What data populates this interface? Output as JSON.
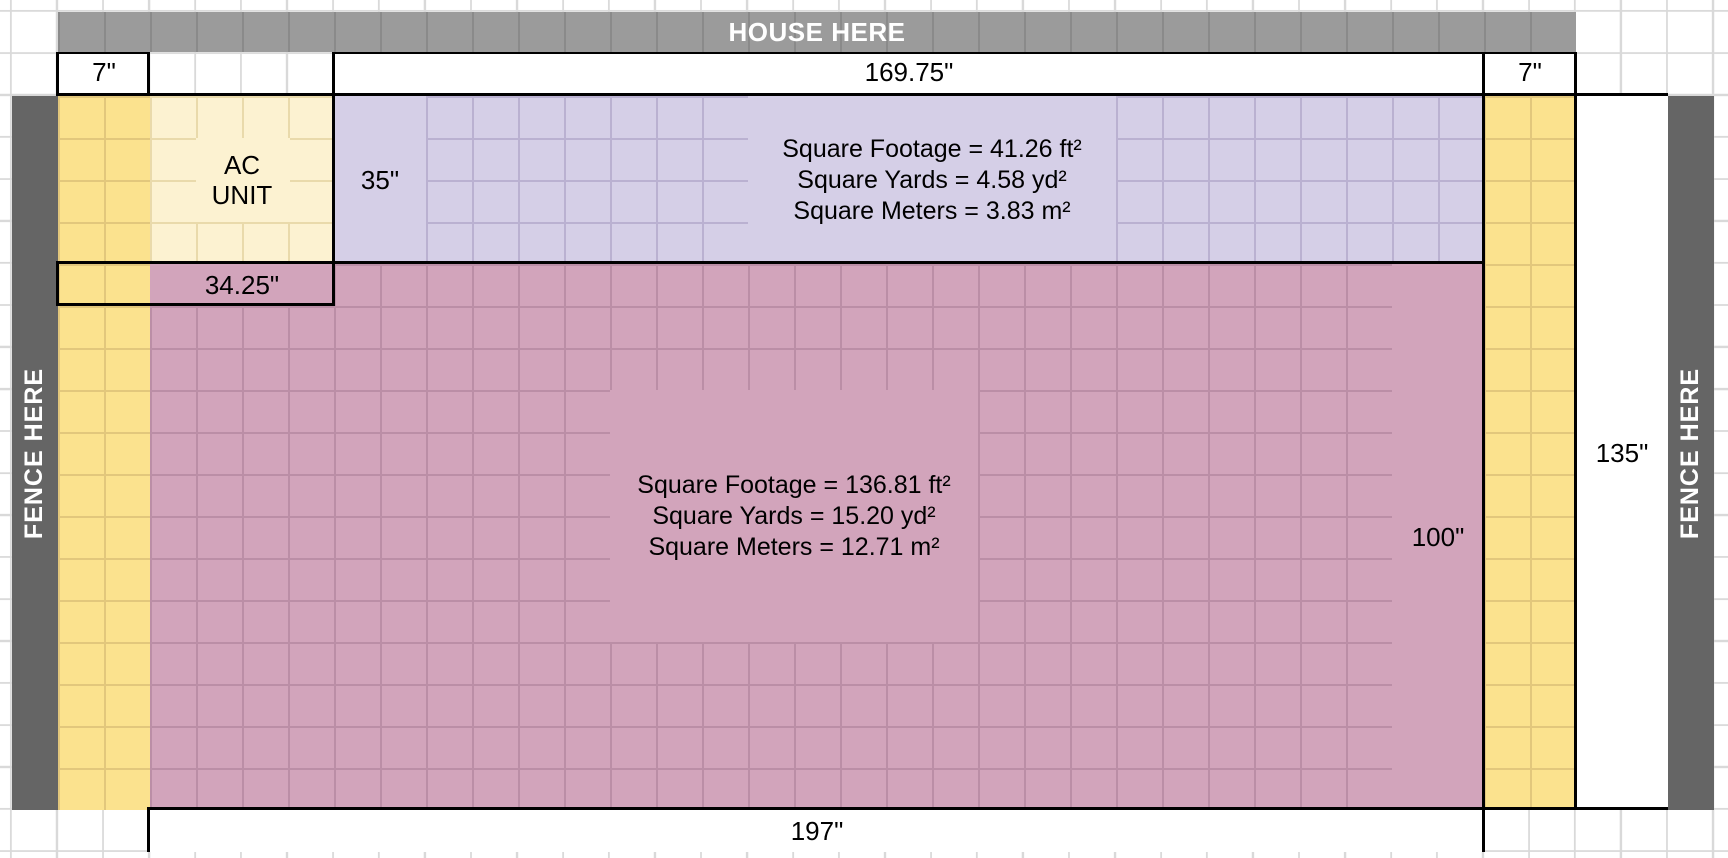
{
  "house": {
    "label": "HOUSE HERE"
  },
  "fence_left": {
    "label": "FENCE HERE"
  },
  "fence_right": {
    "label": "FENCE HERE"
  },
  "ac_unit": {
    "line1": "AC",
    "line2": "UNIT"
  },
  "dimensions": {
    "left_offset": "7\"",
    "house_width": "169.75\"",
    "right_offset": "7\"",
    "upper_height": "35\"",
    "ac_width": "34.25\"",
    "lower_height": "100\"",
    "right_height": "135\"",
    "total_width": "197\""
  },
  "upper_area": {
    "stats": [
      "Square Footage = 41.26 ft²",
      "Square Yards = 4.58 yd²",
      "Square Meters = 3.83 m²"
    ]
  },
  "lower_area": {
    "stats": [
      "Square Footage = 136.81 ft²",
      "Square Yards = 15.20 yd²",
      "Square Meters = 12.71 m²"
    ]
  },
  "colors": {
    "house_bar": "#9b9b9b",
    "fence": "#656565",
    "yellow_strip": "#fbe28e",
    "ac_fill": "#fcf2d1",
    "upper_fill": "#d5cfe7",
    "lower_fill": "#d2a4bb",
    "sheet_gridline": "#d9d9d9",
    "border": "#000000"
  }
}
